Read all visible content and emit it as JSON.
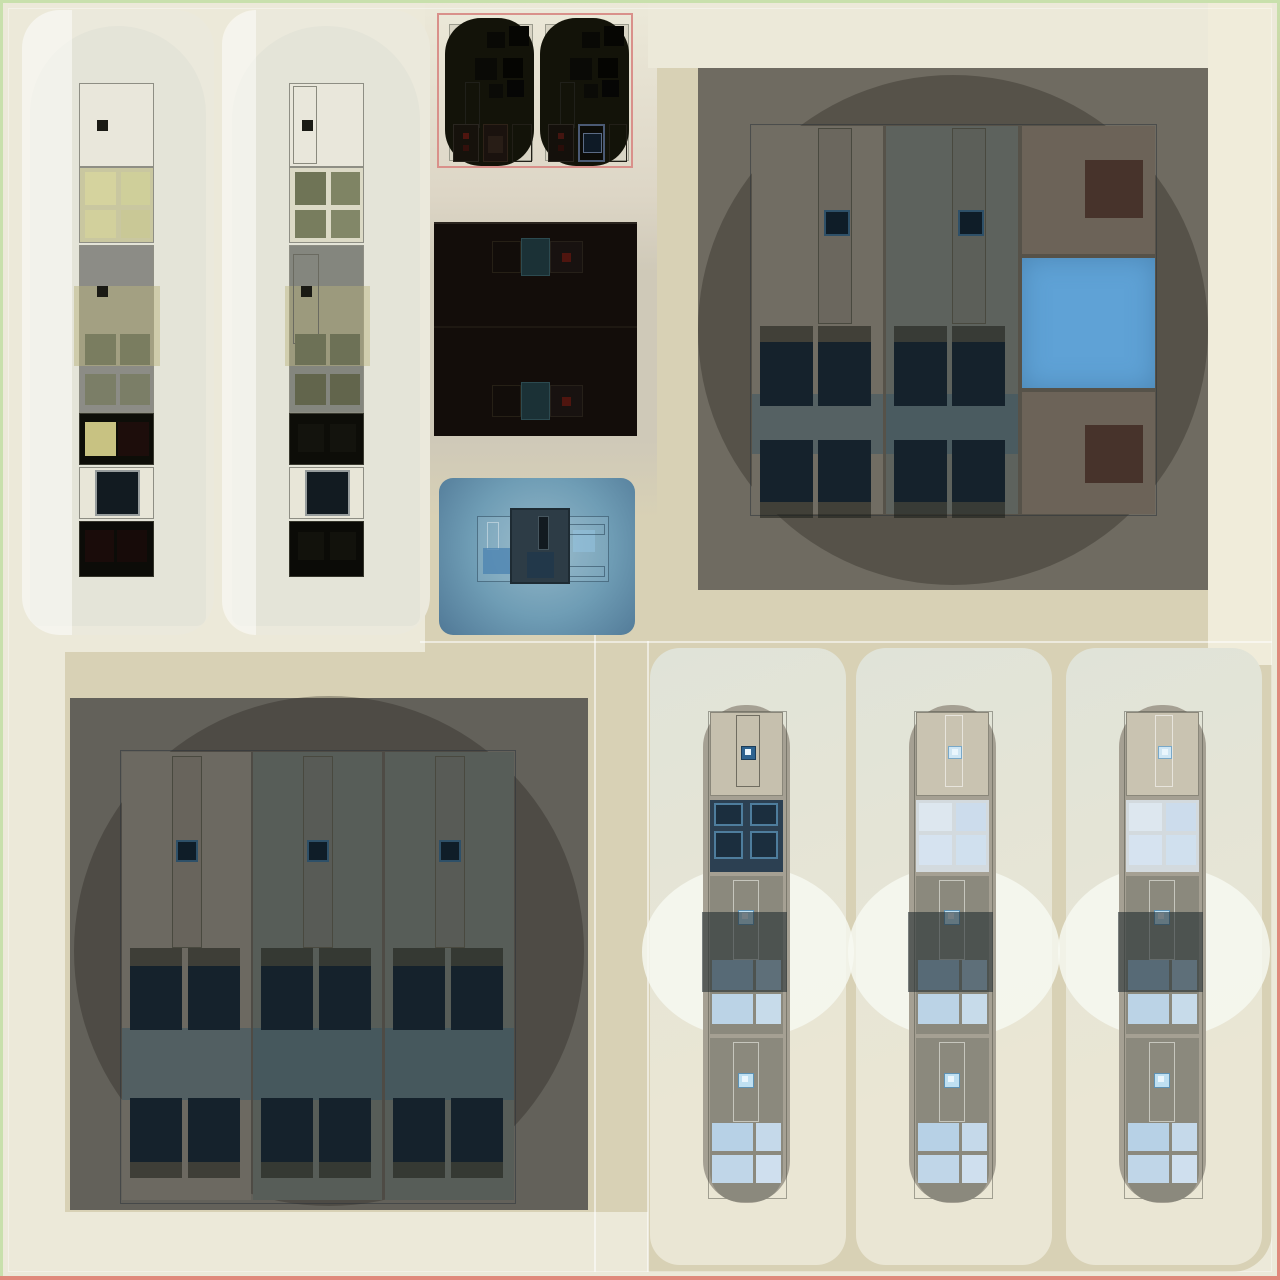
{
  "scene": {
    "title": "top-down facility scene",
    "left_cabinet_cards": {
      "count": 2
    },
    "pod_box": {
      "pod_count": 2,
      "selected": true
    },
    "dark_panel": {
      "machine_motifs": 2
    },
    "blue_pad": {
      "machine_count": 1
    },
    "top_right_room": {
      "cabinet_columns": 2,
      "side_tiles": [
        "brown-tile",
        "blue-tile",
        "brown-tile"
      ]
    },
    "bottom_left_room": {
      "cabinet_columns": 3
    },
    "vehicle_bays": {
      "count": 3
    }
  },
  "palette": {
    "border_green": "#c8e0ac",
    "border_pink": "#e0897c",
    "bg_cream": "#ece9d9",
    "bg_cream2": "#f0ecda",
    "bg_tan": "#d8d1b5",
    "mid_grey_tan": "#cfc9b8",
    "card_ivory": "#ebe9dc",
    "arch_grey": "#e3e3d7",
    "strip_border": "#8e8e84",
    "sq_black": "#1a1a14",
    "yellow_bg_a": "#c9c7a0",
    "yellow_sq_a": "#d5d39e",
    "yellow_bg_b": "#dcdac6",
    "olive_sq_b": "#7b8060",
    "grey_section_a": "#8c8c86",
    "grey_section_b": "#84867e",
    "olive_overlay": "#bab37d",
    "olive_sq_grey": "#73775a",
    "black_section": "#0d0d08",
    "yellow_sq2": "#c8c282",
    "maroon_sq": "#1d0d0b",
    "cream_section": "#e8e6d8",
    "navy_sq": "#121b21",
    "navy_sq_border": "#969c9c",
    "pod_box_pink": "#d9908a",
    "ghost_fill": "#d8d4c4",
    "pod_dark": "#131309",
    "dark_panel": "#130d0a",
    "teal_chip": "#1b3136",
    "red_dot": "#4f150f",
    "blue_pad_in": "#93b7c8",
    "blue_pad_out": "#507896",
    "machine_block": "#2d3c46",
    "room_tr": "#6f6b61",
    "room_bl": "#63615a",
    "col_light_tr": "#716d63",
    "col_teal_tr": "#5d625d",
    "col_light_bl": "#6c6961",
    "col_teal_bl": "#575d58",
    "chip_navy": "#0f1d28",
    "chip_border": "#2e5068",
    "grid_navy": "#15222c",
    "brown_tile_bg": "#6c6358",
    "brown_tile_sq": "#47332b",
    "blue_tile": "#5fa2d6",
    "bay_grad1": "#e0e3d8",
    "bay_grad2": "#eae6d4",
    "pill_grey": "#a5a093",
    "vsec_beige": "#c6c0ae",
    "vsec_grey": "#8b897d",
    "vgrid_bg": "#2c4052",
    "vgrid_sq": "#1b2e3e",
    "vgrid_sq_border": "#4e7d9d",
    "vwin_bg": "#d3dade",
    "vchip_blue": "#bfe0f2",
    "vchip_border": "#5e92b4",
    "pane1": "#a3c2dc",
    "pane2": "#b5cfe4",
    "pane3": "#bbd3e6",
    "pane4": "#c7dbea"
  }
}
